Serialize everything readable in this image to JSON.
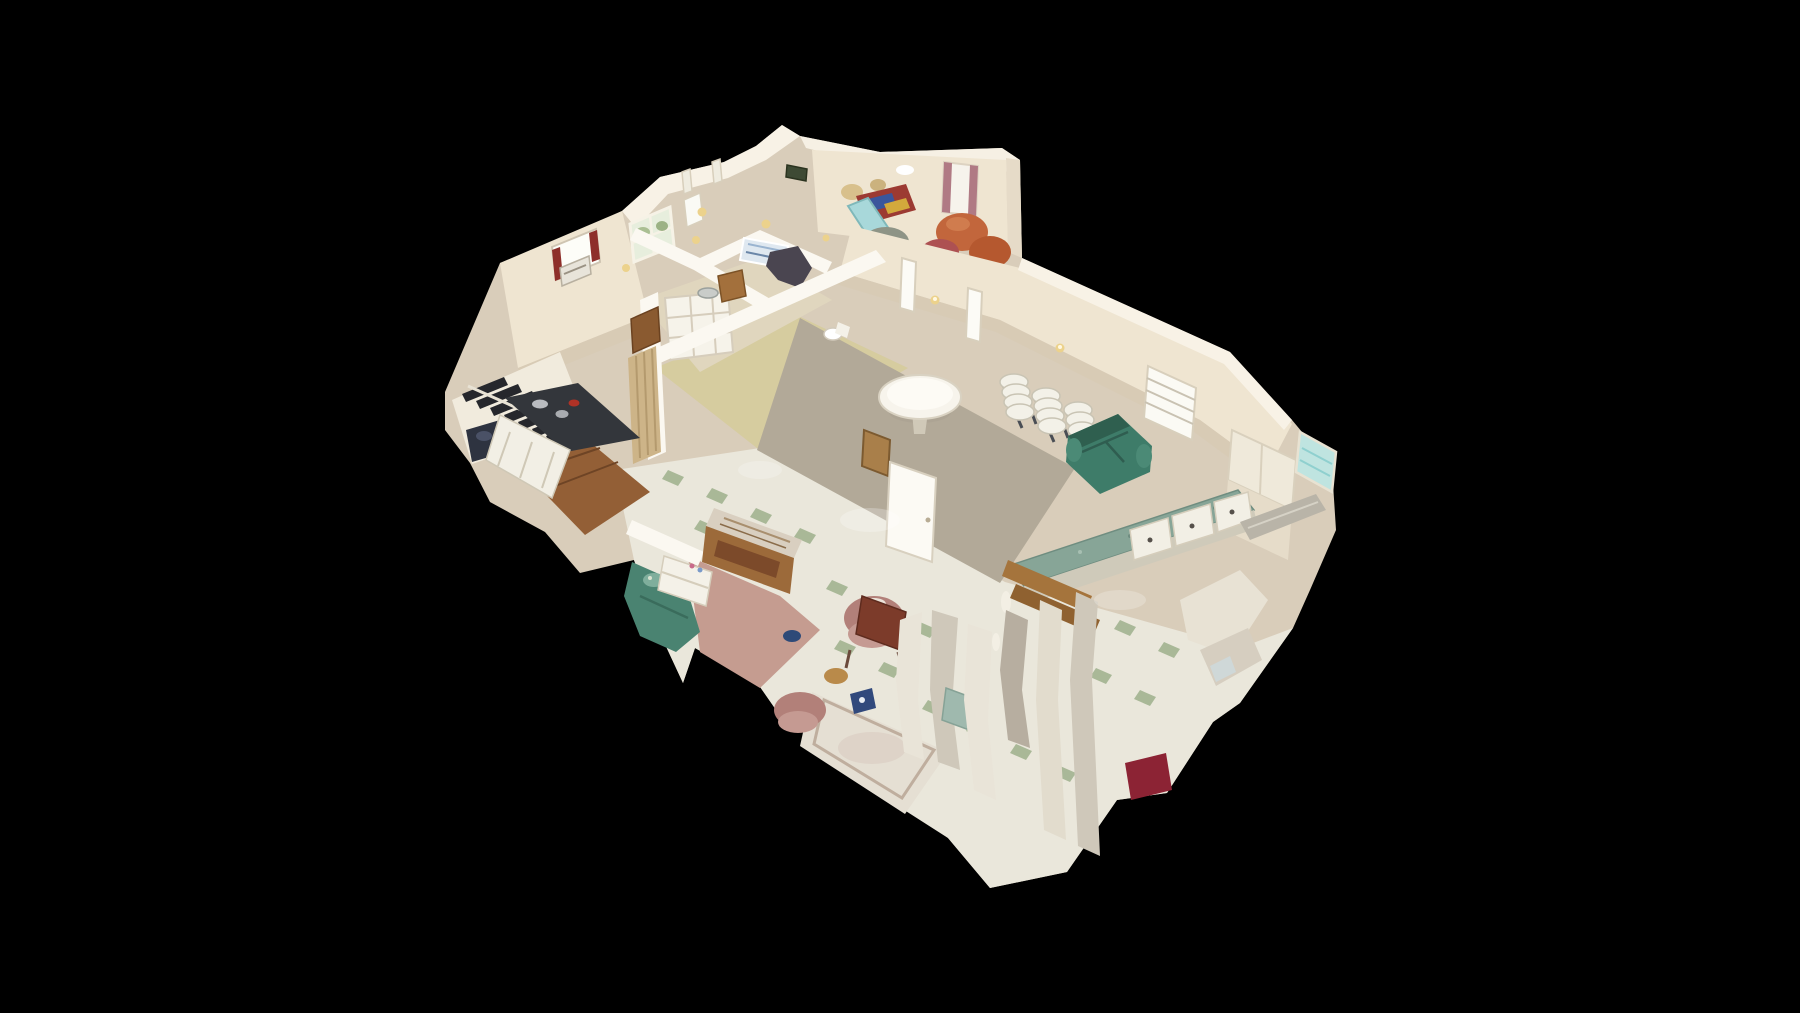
{
  "viewer": {
    "mode": "dollhouse-3d-view",
    "description": "Top-down oblique cutaway (dollhouse) view of a 3D-scanned single-story building interior floating on a black void; no UI chrome, text or watermark visible",
    "background": "#000000"
  },
  "palette": {
    "background": "#000000",
    "wall_base": "#d9cdba",
    "wall_lit": "#efe5d1",
    "wall_bright": "#f8f2e6",
    "wall_shadow": "#d8cbb5",
    "wall_cut": "#fbf8f1",
    "window_glass": "#fdfdf8",
    "window_trees": "#e7eedd",
    "aqua_window": "#bfe4e0",
    "floor_tile": "#eae7db",
    "tile_green": "#a2b390",
    "floor_carpet": "#b2a998",
    "floor_vinyl": "#d6cc9f",
    "floor_corridor": "#e0d6be",
    "floor_wood": "#935f36",
    "floor_pink": "#c59c90",
    "rug": "#e5dfd3",
    "carpet_red": "#8c2334",
    "sofa_green": "#3e7c69",
    "sofa_teal": "#4a8371",
    "counter_teal": "#87a597",
    "counter_steel": "#b9b4a8",
    "cabinet_white": "#f2efe5",
    "stove_dark": "#33363b",
    "stair_dark": "#26272c",
    "bag_navy": "#2e3340",
    "table_white": "#f7f4ec",
    "chair_white": "#f3f1e8",
    "door_wood": "#8a5a30",
    "folding_door": "#cdb488",
    "pew_wood": "#9c6a3a",
    "chair_pink": "#b28079",
    "clutter_orange": "#c2663c",
    "clutter_red": "#9c3a32",
    "clutter_blue": "#3a569c",
    "clutter_lightblue": "#a8d8da",
    "curtain_red": "#8e2f2a",
    "curtain_mauve": "#b07a84",
    "sconce_gold": "#ecd28c"
  },
  "scene": {
    "type": "photogrammetry-dollhouse",
    "rooms": [
      {
        "id": "upper-left-wing",
        "label": "bedroom and bathroom wing with exterior windows and AC unit"
      },
      {
        "id": "storage-room",
        "label": "cluttered storage room with recliners, quilts and lamps"
      },
      {
        "id": "main-hall",
        "label": "main hall with round table, stacked folding chairs and loveseat"
      },
      {
        "id": "kitchenette",
        "label": "kitchenette with teal laminate counters"
      },
      {
        "id": "kitchen-stairs",
        "label": "kitchen with dark staircase"
      },
      {
        "id": "sitting-room",
        "label": "sitting room with sofa bed, pew and armchairs"
      },
      {
        "id": "lower-rooms",
        "label": "fragmented lower rooms with scan tears"
      }
    ],
    "objects": [
      "dark-staircase",
      "trash-bag",
      "kitchen-stove",
      "white-cabinets",
      "accordion-folding-door",
      "wood-door",
      "cubby-shelf",
      "crib",
      "toilet",
      "high-chair",
      "round-folding-table",
      "stacked-folding-chairs",
      "green-leather-loveseat",
      "teal-counter-peninsula",
      "drawer-cabinets",
      "open-white-door",
      "cork-board",
      "louvered-window",
      "glass-block-window",
      "sofa-bed",
      "nightstand",
      "wooden-pew-with-tapestry",
      "pink-armchair",
      "patterned-rug",
      "red-carpet-piece",
      "wall-fragments",
      "window-curtains",
      "wall-sconces"
    ]
  }
}
